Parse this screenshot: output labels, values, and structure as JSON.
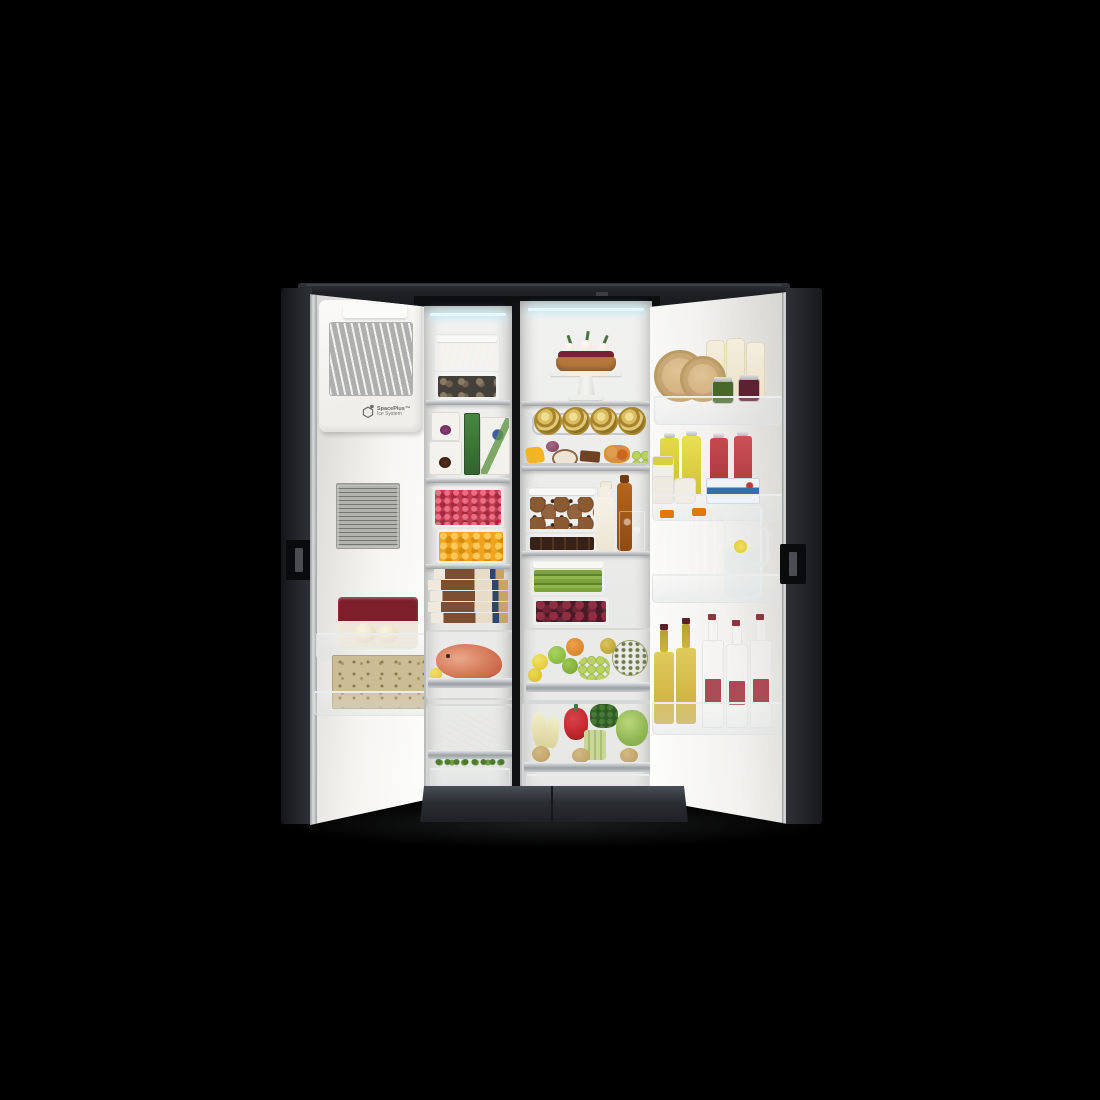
{
  "scene": {
    "type": "product-photo",
    "description": "Side-by-side refrigerator with both doors open, fully stocked with fresh food, photographed on a black background",
    "logo": {
      "line1": "SpacePlus™",
      "line2": "Ice System"
    }
  },
  "left_door": {
    "title": "Freezer door (open) with automatic ice maker",
    "ice_maker": "SpacePlus ice maker unit with clear ice tray window",
    "spec_label": "Gray specification label with fine print",
    "bin1": "Maroon ice cream tub with vanilla scoops artwork",
    "bin2": "Kraft ice cream cones box with cartoon artwork"
  },
  "freezer": {
    "title": "Freezer compartment",
    "shelf1": "Stacked containers: salmon fillets on top, mussels below",
    "shelf2": "Two white ice cream tubs, box of frozen green beans, frozen dessert carton",
    "shelf3": "Container of raspberries over container of mango cubes",
    "shelf4": "Stack of five boxed frozen products",
    "drawer1": "Whole fish with a lemon slice",
    "drawer2": "Beef steak resting on fresh herbs"
  },
  "fridge": {
    "title": "Refrigerator compartment",
    "shelf1": "Berry tart with whipped cream on a white cake stand",
    "can_rack": "Four gold cans lying on a hanging wire rack",
    "shelf2": "Cheese and fruit platter with figs, mango, coconut and chocolate",
    "shelf3": "Container of cookies, container of brownies, bottle of milk, bottle of honey, glass of iced tea",
    "shelf4": "Container of asparagus over container of cherries",
    "drawer1": "Fruit drawer: lemons, green apples, orange, grapes, pear, melon",
    "drawer2": "Vegetable drawer: endive, red bell pepper, leafy greens, lettuce, celery, root vegetables"
  },
  "right_door": {
    "title": "Refrigerator door (open) with bottle bins",
    "bin1": "Two cheese wheels, three milk bottles, two preserve jars",
    "bin2": "Two lemon juice bottles, two berry juice bottles, jars, butter pack",
    "bin3": "Two orange juice jugs and a pitcher of lemon water",
    "bin4": "Two white wine bottles and three sparkling water bottles"
  },
  "colors": {
    "background": "#000000",
    "cabinet": "#23262b",
    "door_interior": "#f4f3f0",
    "metal_trim": "#b9bcbe",
    "led_light": "#e8f7fe",
    "orange_juice": "#f5a40a",
    "raspberry": "#c23b50",
    "mango": "#f0a41d",
    "beef": "#8e2129",
    "salmon": "#d96a4f",
    "gold_can": "#c9a63f",
    "wine_bottle": "#dcc452",
    "juice_red": "#bf4347",
    "juice_yellow": "#ddd24a"
  }
}
